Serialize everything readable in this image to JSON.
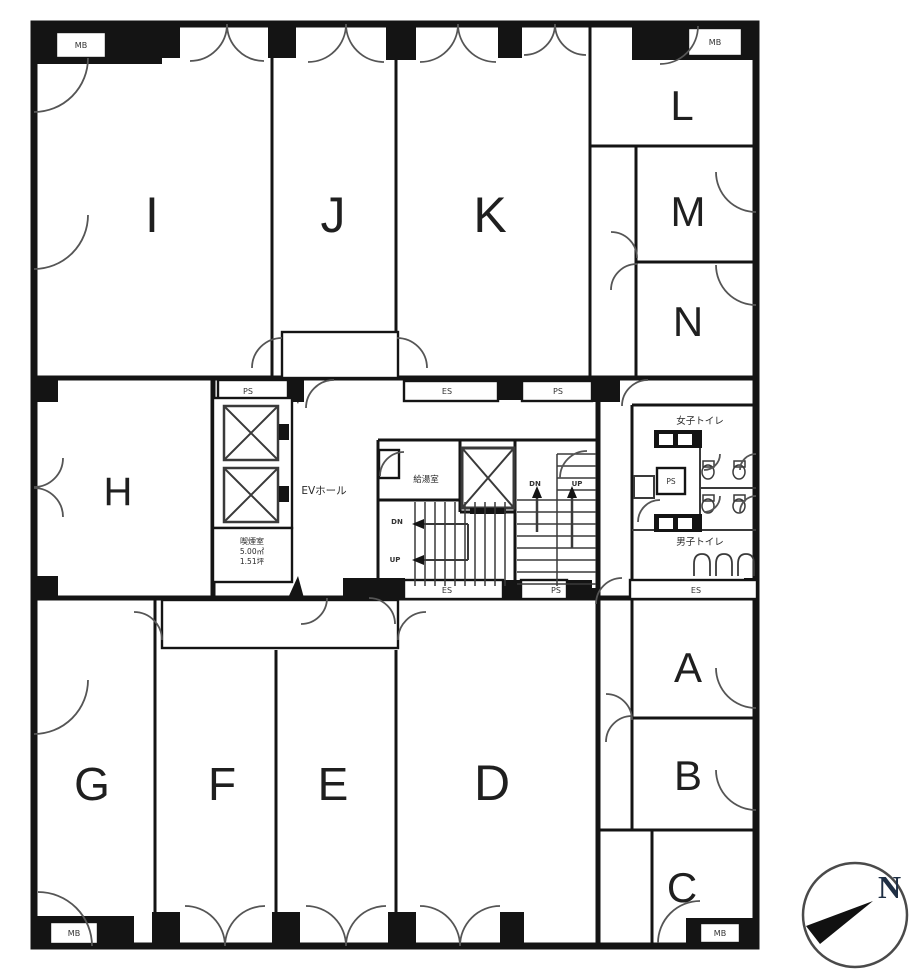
{
  "plan": {
    "rooms": [
      {
        "label": "I"
      },
      {
        "label": "J"
      },
      {
        "label": "K"
      },
      {
        "label": "L"
      },
      {
        "label": "M"
      },
      {
        "label": "N"
      },
      {
        "label": "H"
      },
      {
        "label": "G"
      },
      {
        "label": "F"
      },
      {
        "label": "E"
      },
      {
        "label": "D"
      },
      {
        "label": "A"
      },
      {
        "label": "B"
      },
      {
        "label": "C"
      }
    ],
    "core": {
      "ev_hall": "EVホール",
      "kitchenette": "給湯室",
      "smoking_room": {
        "name": "喫煙室",
        "area_m2": "5.00㎡",
        "area_tsubo": "1.51坪"
      },
      "womens_toilet": "女子トイレ",
      "mens_toilet": "男子トイレ",
      "down": "DN",
      "up": "UP"
    },
    "shaft_labels": {
      "ps": "PS",
      "es": "ES",
      "mb": "MB"
    },
    "compass": {
      "north": "N"
    },
    "colors": {
      "wall": "#141414",
      "background": "#ffffff",
      "compass_n": "#1f2f44"
    }
  }
}
